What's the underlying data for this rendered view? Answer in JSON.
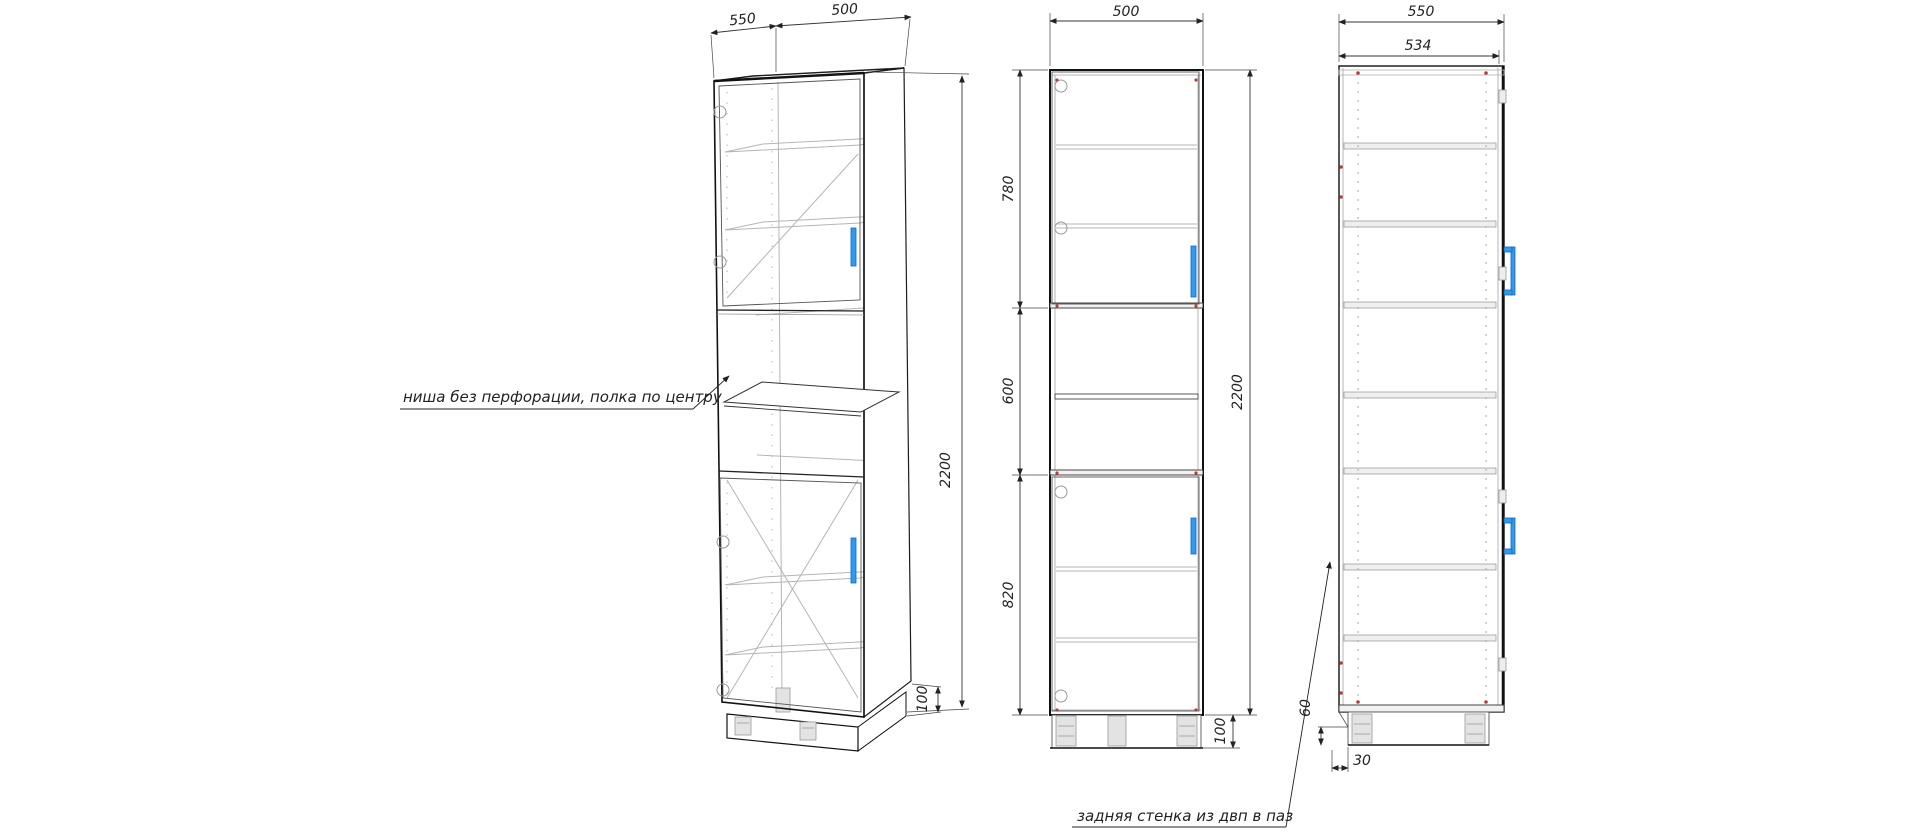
{
  "annotations": {
    "niche_note": "ниша без перфорации, полка по центру",
    "back_wall_note": "задняя стенка из двп в паз"
  },
  "views": {
    "isometric": {
      "dim_depth": "550",
      "dim_width": "500",
      "dim_height": "2200",
      "dim_plinth": "100"
    },
    "front": {
      "dim_width": "500",
      "dim_top_section": "780",
      "dim_middle_section": "600",
      "dim_bottom_section": "820",
      "dim_height": "2200",
      "dim_plinth": "100"
    },
    "side": {
      "dim_depth": "550",
      "dim_inner_depth": "534",
      "dim_plinth_height": "60",
      "dim_back_offset": "30"
    }
  },
  "colors": {
    "handle_blue": "#2f9bea",
    "screw_red": "#b04040",
    "line_dark": "#1c1c1c",
    "line_gray": "#b5b5b5"
  }
}
